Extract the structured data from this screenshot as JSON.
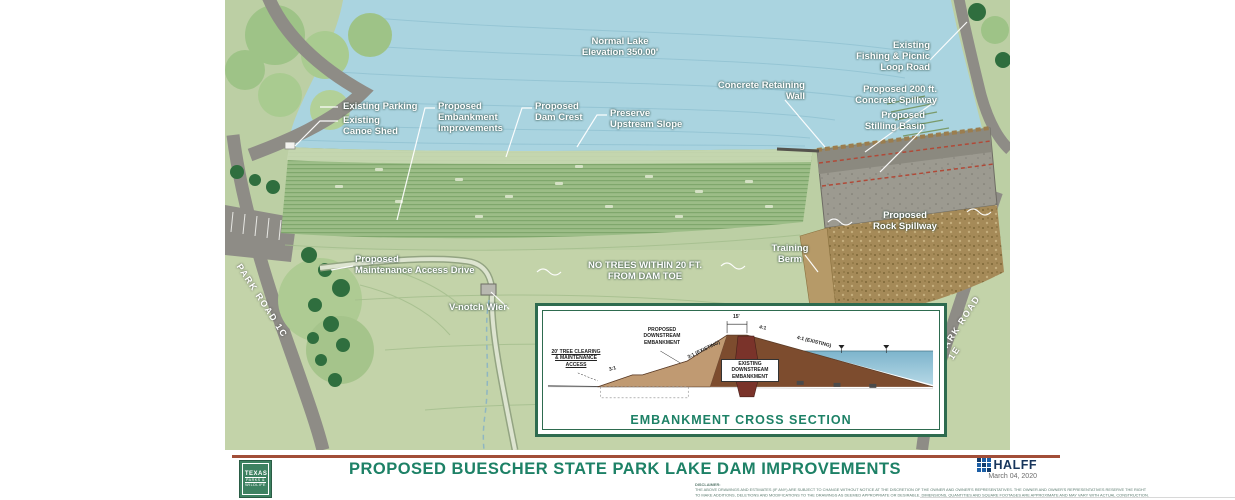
{
  "map": {
    "labels": [
      {
        "id": "normal-lake-elevation",
        "text": "Normal Lake\nElevation 350.00'"
      },
      {
        "id": "concrete-retaining-wall",
        "text": "Concrete Retaining\nWall"
      },
      {
        "id": "existing-fishing-picnic-loop-road",
        "text": "Existing\nFishing & Picnic\nLoop Road"
      },
      {
        "id": "proposed-200ft-concrete-spillway",
        "text": "Proposed 200 ft.\nConcrete Spillway"
      },
      {
        "id": "proposed-stilling-basin",
        "text": "Proposed\nStilling Basin"
      },
      {
        "id": "existing-parking",
        "text": "Existing Parking"
      },
      {
        "id": "existing-canoe-shed",
        "text": "Existing\nCanoe Shed"
      },
      {
        "id": "proposed-embankment-improvements",
        "text": "Proposed\nEmbankment\nImprovements"
      },
      {
        "id": "proposed-dam-crest",
        "text": "Proposed\nDam Crest"
      },
      {
        "id": "preserve-upstream-slope",
        "text": "Preserve\nUpstream Slope"
      },
      {
        "id": "proposed-rock-spillway",
        "text": "Proposed\nRock Spillway"
      },
      {
        "id": "training-berm",
        "text": "Training\nBerm"
      },
      {
        "id": "proposed-maintenance-access-drive",
        "text": "Proposed\nMaintenance Access Drive"
      },
      {
        "id": "v-notch-wier",
        "text": "V-notch Wier"
      },
      {
        "id": "no-trees-note",
        "text": "NO TREES WITHIN 20 FT.\nFROM DAM TOE"
      },
      {
        "id": "park-road-left",
        "text": "PARK ROAD 1C"
      },
      {
        "id": "park-road-right",
        "text": "PARK ROAD 1E"
      }
    ]
  },
  "cross_section": {
    "caption": "EMBANKMENT CROSS SECTION",
    "labels": {
      "tree_clearing": "20' TREE CLEARING\n& MAINTENANCE\nACCESS",
      "proposed_downstream": "PROPOSED\nDOWNSTREAM\nEMBANKMENT",
      "existing_downstream": "EXISTING\nDOWNSTREAM\nEMBANKMENT",
      "slope_3_1": "3:1",
      "slope_3_1_existing": "3:1 (EXISTING)",
      "slope_4_1": "4:1",
      "slope_4_1_existing": "4:1 (EXISTING)",
      "crest_width": "15'"
    }
  },
  "footer": {
    "title": "PROPOSED BUESCHER STATE PARK LAKE DAM IMPROVEMENTS",
    "firm": "HALFF",
    "date": "March 04, 2020",
    "tpwd": {
      "line1": "TEXAS",
      "line2": "PARKS &",
      "line3": "WILDLIFE"
    },
    "disclaimer_heading": "DISCLAIMER:",
    "disclaimer_1": "THE ABOVE DRAWINGS AND ESTIMATES (IF ANY) ARE SUBJECT TO CHANGE WITHOUT NOTICE AT THE DISCRETION OF THE OWNER AND OWNER'S REPRESENTATIVES. THE OWNER AND OWNER'S REPRESENTATIVES RESERVE THE RIGHT",
    "disclaimer_2": "TO MAKE ADDITIONS, DELETIONS AND MODIFICATIONS TO THE DRAWINGS AS DEEMED APPROPRIATE OR DESIRABLE. DIMENSIONS, QUANTITIES AND SQUARE FOOTAGES ARE APPROXIMATE AND MAY VARY WITH ACTUAL CONSTRUCTION."
  },
  "colors": {
    "title_green": "#1d8166",
    "rule_red": "#a24e38",
    "lake_blue": "#aad4e0",
    "land_green": "#bccfa4",
    "embankment_green": "#9cbd87",
    "rock_brown": "#a58a58",
    "concrete_gray": "#9c9a90",
    "frame_green": "#2e6b4f",
    "halff_blue": "#1d5fa5",
    "tpwd_green": "#3d8161"
  }
}
